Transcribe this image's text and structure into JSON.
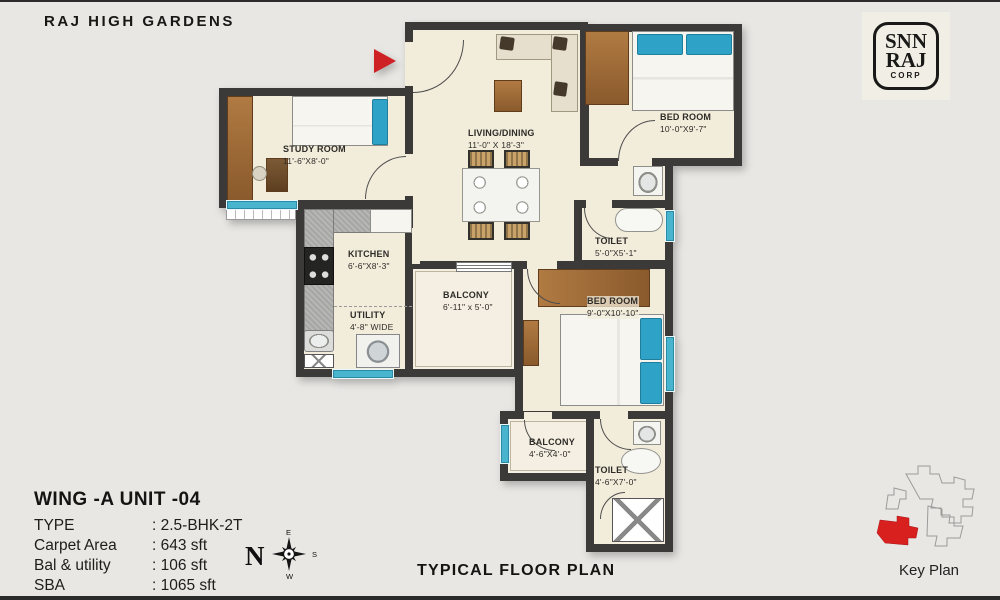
{
  "header": {
    "title": "RAJ HIGH GARDENS"
  },
  "logo": {
    "line1": "SNN",
    "line2": "RAJ",
    "line3": "CORP"
  },
  "rooms": {
    "study": {
      "name": "STUDY ROOM",
      "dim": "11'-6\"X8'-0\""
    },
    "living": {
      "name": "LIVING/DINING",
      "dim": "11'-0\" X 18'-3\""
    },
    "bedroom1": {
      "name": "BED ROOM",
      "dim": "10'-0\"X9'-7\""
    },
    "kitchen": {
      "name": "KITCHEN",
      "dim": "6'-6\"X8'-3\""
    },
    "utility": {
      "name": "UTILITY",
      "dim": "4'-8\" WIDE"
    },
    "toilet1": {
      "name": "TOILET",
      "dim": "5'-0\"X5'-1\""
    },
    "balcony1": {
      "name": "BALCONY",
      "dim": "6'-11\" x 5'-0\""
    },
    "bedroom2": {
      "name": "BED ROOM",
      "dim": "9'-0\"X10'-10\""
    },
    "balcony2": {
      "name": "BALCONY",
      "dim": "4'-6\"X4'-0\""
    },
    "toilet2": {
      "name": "TOILET",
      "dim": "4'-6\"X7'-0\""
    }
  },
  "unit_info": {
    "heading": "WING -A  UNIT -04",
    "rows": [
      {
        "label": "TYPE",
        "value": ": 2.5-BHK-2T"
      },
      {
        "label": "Carpet Area",
        "value": ": 643 sft"
      },
      {
        "label": "Bal & utility",
        "value": ": 106 sft"
      },
      {
        "label": "SBA",
        "value": ": 1065 sft"
      }
    ]
  },
  "captions": {
    "plan": "TYPICAL FLOOR PLAN",
    "key_plan": "Key Plan"
  },
  "compass": {
    "n": "N",
    "e": "E",
    "s": "S",
    "w": "W"
  },
  "colors": {
    "wall": "#3b3a38",
    "floor": "#f2ecdb",
    "accent_red": "#ce2126",
    "window_teal": "#49b4ce",
    "wood": "#a9713d"
  }
}
